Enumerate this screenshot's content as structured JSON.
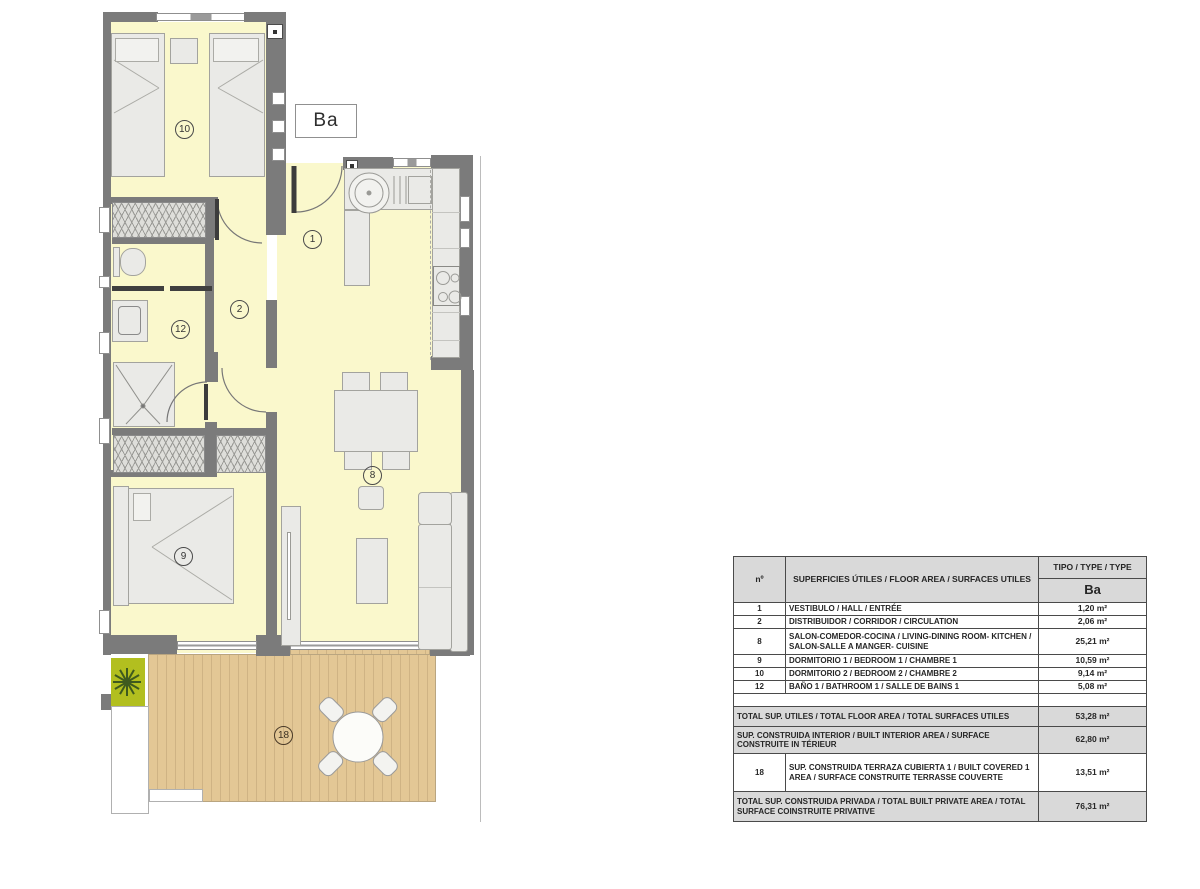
{
  "plan": {
    "type_label": "Ba",
    "room_labels": {
      "hall": "1",
      "corridor": "2",
      "living_kitchen": "8",
      "bedroom_1": "9",
      "bedroom_2": "10",
      "bathroom": "12",
      "terrace": "18"
    },
    "colors": {
      "floor": "#FAF8CC",
      "wall": "#7B7B7B",
      "deck": "#E3C795",
      "plant_box": "#B2BF1F",
      "furniture": "#EAEAE7"
    }
  },
  "table": {
    "header": {
      "no": "nº",
      "description": "SUPERFICIES ÚTILES / FLOOR AREA / SURFACES UTILES",
      "type": "TIPO / TYPE / TYPE",
      "type_value": "Ba"
    },
    "rows": [
      {
        "no": "1",
        "description": "VESTIBULO / HALL / ENTRÉE",
        "value": "1,20 m²"
      },
      {
        "no": "2",
        "description": "DISTRIBUIDOR / CORRIDOR / CIRCULATION",
        "value": "2,06 m²"
      },
      {
        "no": "8",
        "description": "SALON-COMEDOR-COCINA / LIVING-DINING ROOM- KITCHEN / SALON-SALLE A MANGER- CUISINE",
        "value": "25,21 m²"
      },
      {
        "no": "9",
        "description": "DORMITORIO 1 / BEDROOM 1 / CHAMBRE 1",
        "value": "10,59 m²"
      },
      {
        "no": "10",
        "description": "DORMITORIO 2 / BEDROOM 2 / CHAMBRE 2",
        "value": "9,14 m²"
      },
      {
        "no": "12",
        "description": "BAÑO 1 / BATHROOM 1 / SALLE DE BAINS 1",
        "value": "5,08 m²"
      }
    ],
    "summary": [
      {
        "no": "",
        "description": "TOTAL SUP. UTILES / TOTAL FLOOR AREA / TOTAL SURFACES UTILES",
        "value": "53,28 m²"
      },
      {
        "no": "",
        "description": "SUP. CONSTRUIDA INTERIOR / BUILT INTERIOR AREA / SURFACE CONSTRUITE IN TÉRIEUR",
        "value": "62,80 m²"
      },
      {
        "no": "18",
        "description": "SUP. CONSTRUIDA TERRAZA CUBIERTA 1 / BUILT COVERED 1 AREA / SURFACE CONSTRUITE TERRASSE COUVERTE",
        "value": "13,51 m²"
      },
      {
        "no": "",
        "description": "TOTAL SUP. CONSTRUIDA PRIVADA / TOTAL BUILT PRIVATE AREA / TOTAL SURFACE COINSTRUITE PRIVATIVE",
        "value": "76,31 m²"
      }
    ]
  }
}
